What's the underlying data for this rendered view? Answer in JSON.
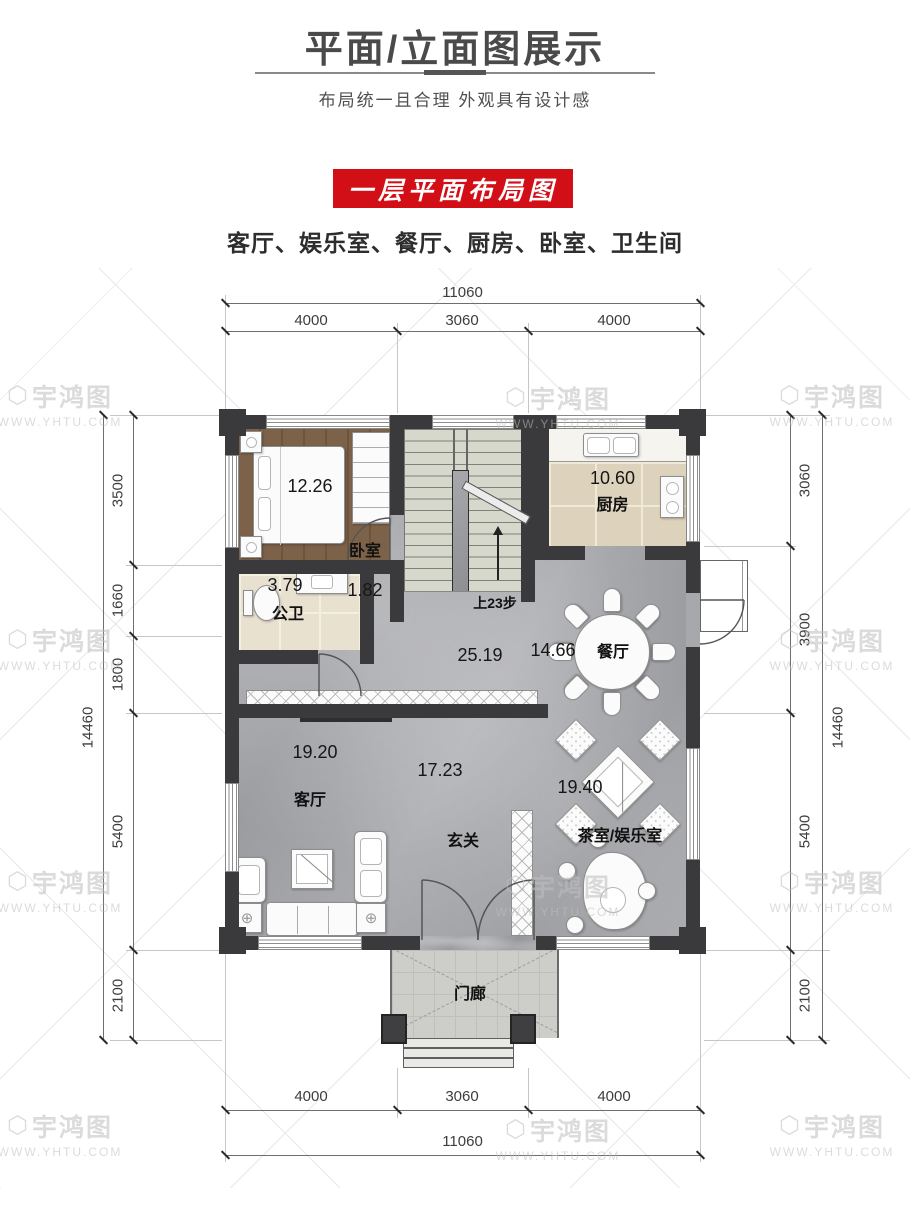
{
  "header": {
    "title": "平面/立面图展示",
    "subtitle": "布局统一且合理  外观具有设计感"
  },
  "banner": {
    "label": "一层平面布局图"
  },
  "summary": {
    "rooms_line": "客厅、娱乐室、餐厅、厨房、卧室、卫生间"
  },
  "watermark": {
    "brand": "宇鸿图",
    "url": "WWW.YHTU.COM",
    "logo": "⬡"
  },
  "colors": {
    "accent_red": "#d20f17",
    "wall": "#3a3a3c"
  },
  "plan": {
    "dimensions": {
      "top": {
        "total": "11060",
        "segments": [
          "4000",
          "3060",
          "4000"
        ]
      },
      "bottom": {
        "total": "11060",
        "segments": [
          "4000",
          "3060",
          "4000"
        ]
      },
      "left": {
        "total": "14460",
        "segments": [
          "3500",
          "1660",
          "1800",
          "5400",
          "2100"
        ]
      },
      "right": {
        "total": "14460",
        "segments": [
          "3060",
          "3900",
          "5400",
          "2100"
        ]
      }
    },
    "rooms": {
      "bedroom": {
        "name": "卧室",
        "area": "12.26"
      },
      "bath": {
        "name": "公卫",
        "area": "3.79"
      },
      "corridor": {
        "area": "1.82"
      },
      "kitchen": {
        "name": "厨房",
        "area": "10.60"
      },
      "dining": {
        "name": "餐厅",
        "area": "14.66"
      },
      "hall": {
        "area": "25.19"
      },
      "living": {
        "name": "客厅",
        "area": "19.20",
        "area2": "17.23"
      },
      "foyer": {
        "name": "玄关"
      },
      "tea": {
        "name": "茶室/娱乐室",
        "area": "19.40"
      },
      "porch": {
        "name": "门廊"
      },
      "stairs": {
        "note": "上23步"
      }
    }
  }
}
